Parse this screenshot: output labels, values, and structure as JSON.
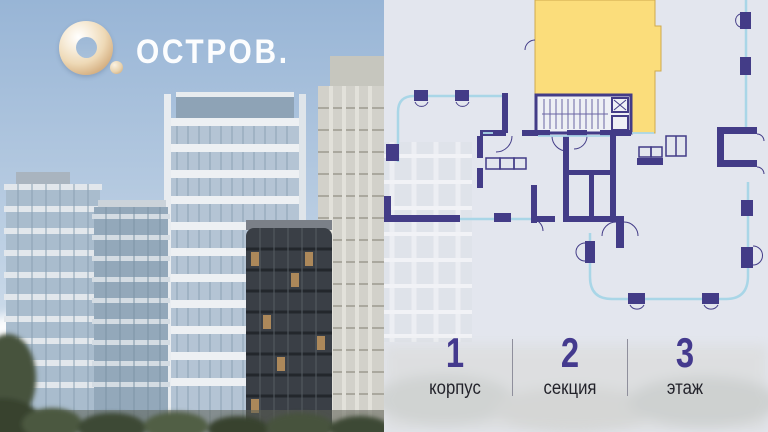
{
  "brand": {
    "wordmark": "ОСТРОВ.",
    "logo_icon": "gold-torus-o-icon",
    "logo_gold_color": "#e9cfa6",
    "wordmark_color": "#fcfdfe"
  },
  "plan": {
    "kind": "apartment-floor-plan",
    "highlighted_unit_color": "#fbdd7b",
    "wall_color": "#433c87",
    "balcony_line_color": "#a9d6e7",
    "panel_background": "#e3e6ee"
  },
  "info": {
    "items": [
      {
        "value": "1",
        "label": "корпус"
      },
      {
        "value": "2",
        "label": "секция"
      },
      {
        "value": "3",
        "label": "этаж"
      }
    ],
    "value_color": "#443a8e",
    "label_color": "#23232b"
  }
}
